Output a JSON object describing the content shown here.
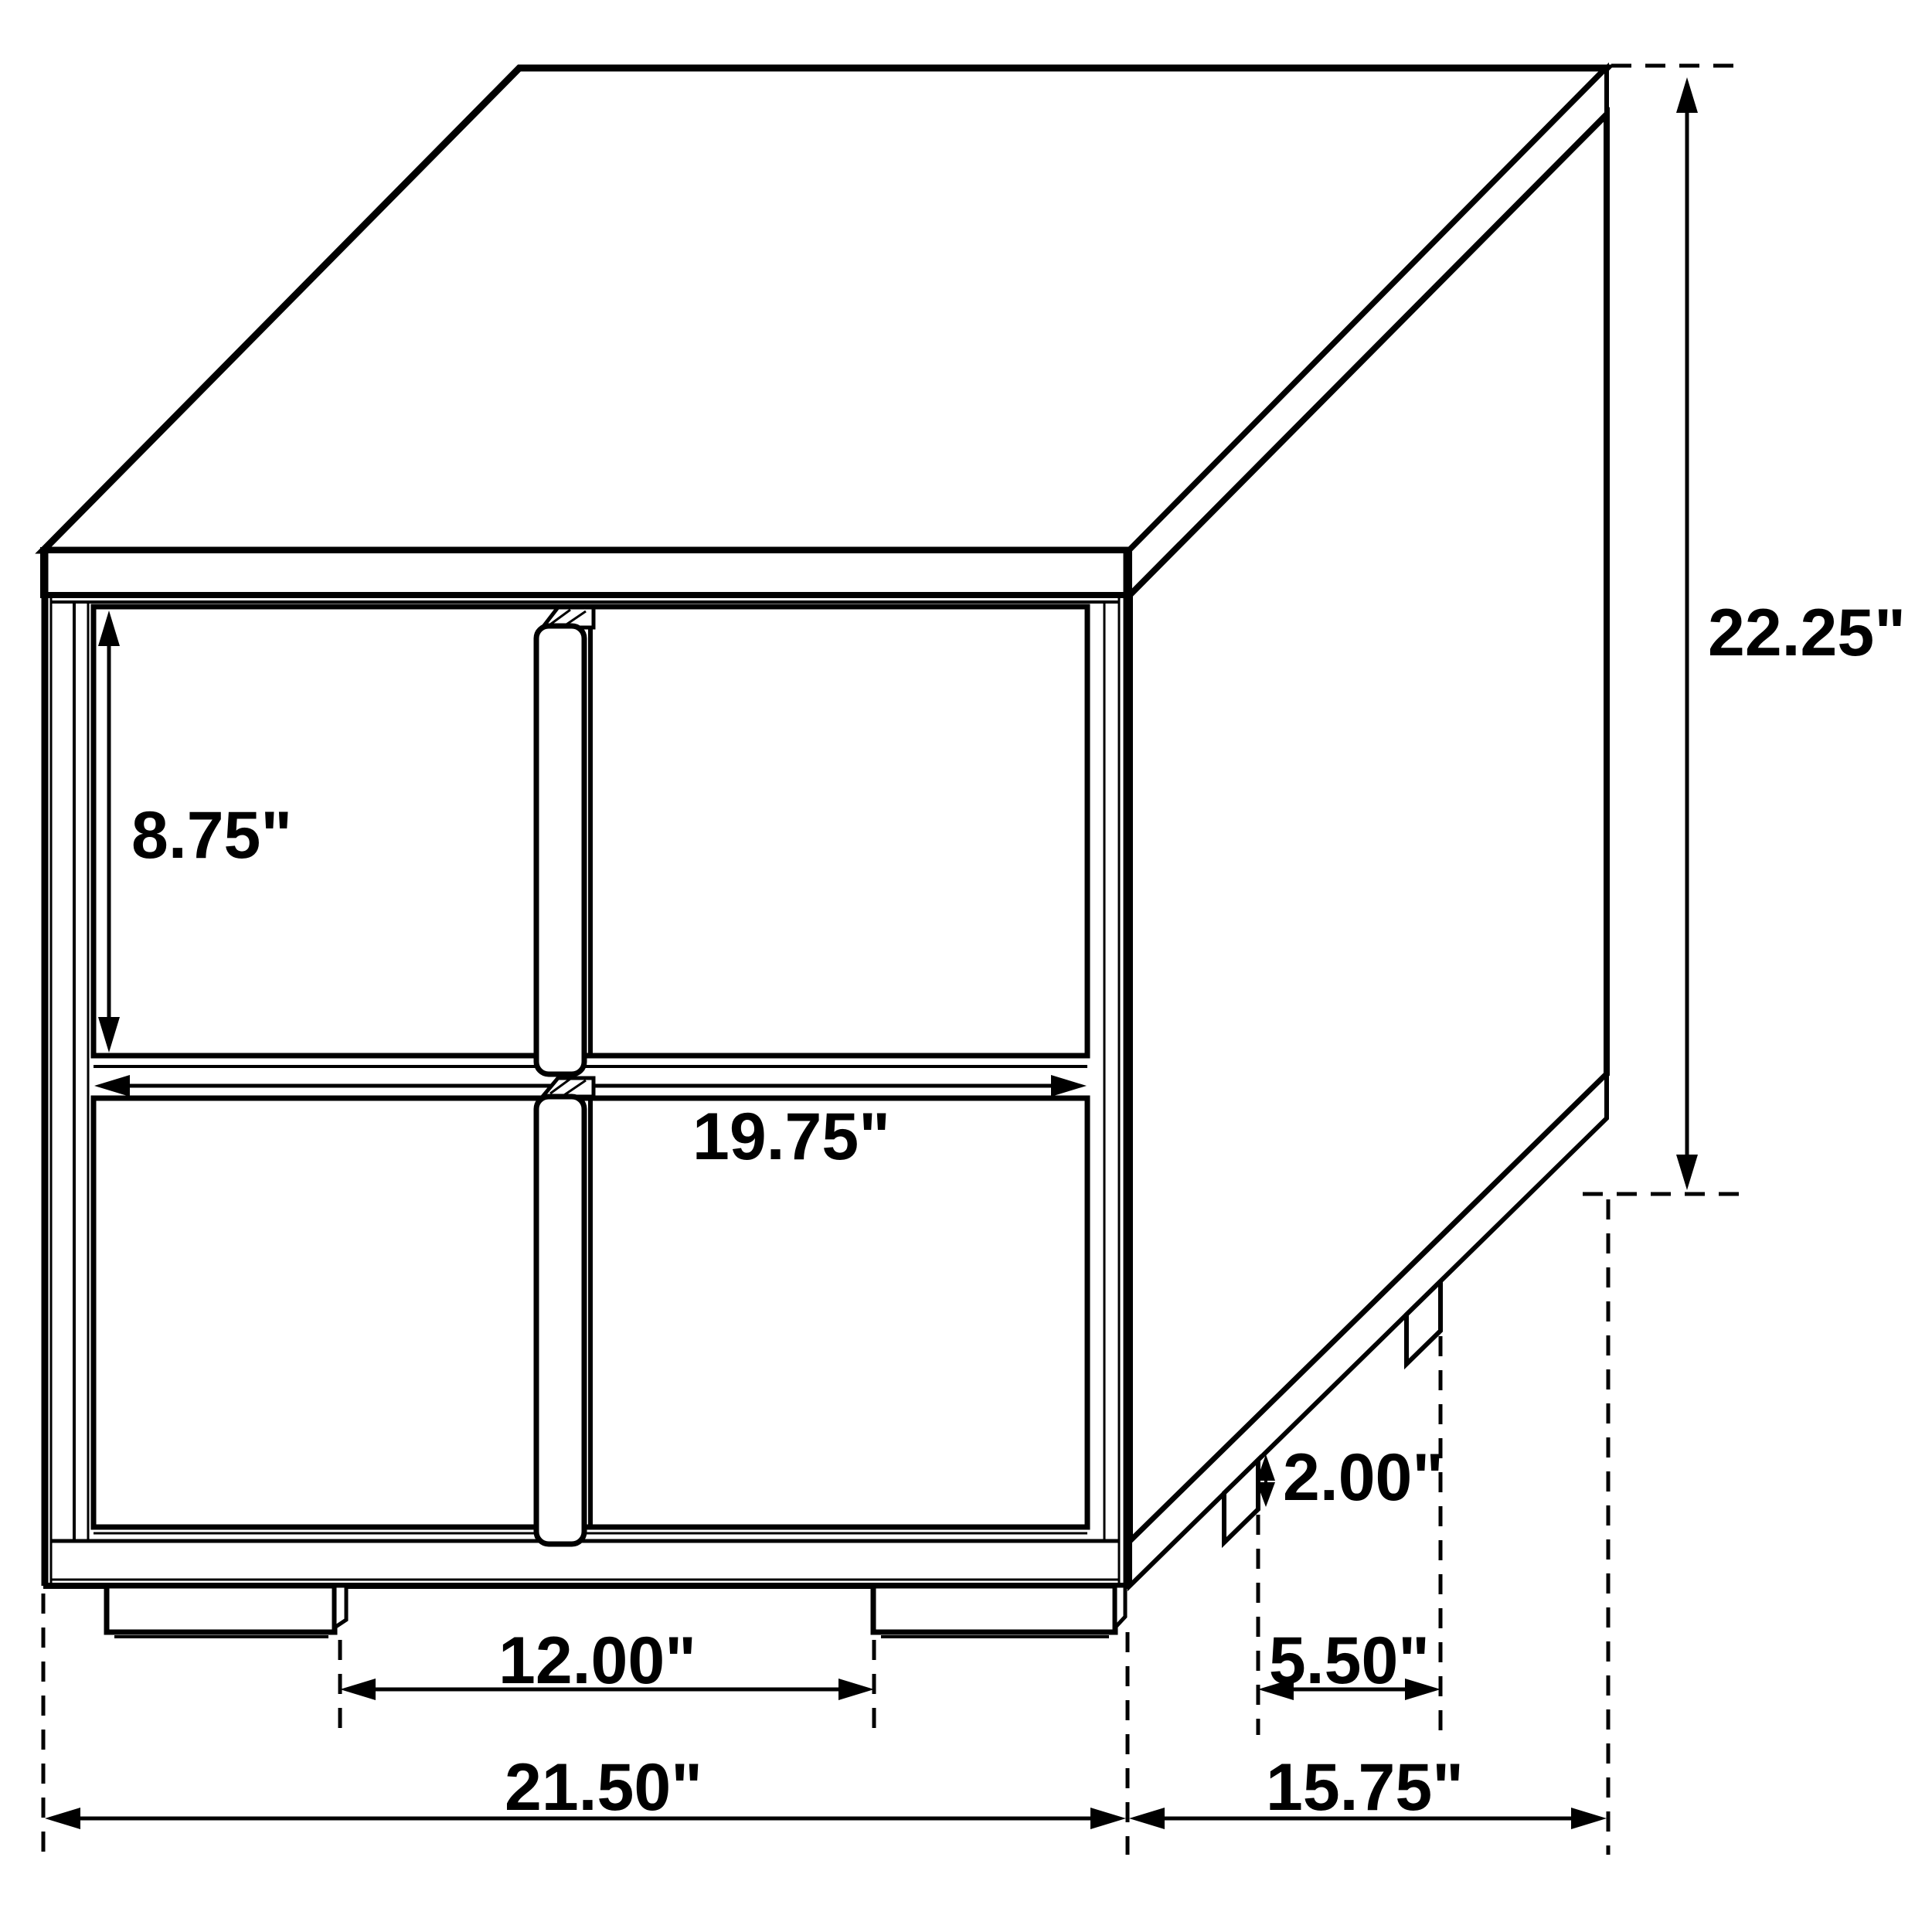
{
  "page": {
    "background": "#ffffff",
    "line_color": "#000000"
  },
  "diagram": {
    "type": "furniture-dimension-drawing",
    "subject": "two-drawer nightstand with center vertical pulls",
    "unit": "inches",
    "labels": {
      "drawer_height": "8.75\"",
      "drawer_width": "19.75\"",
      "overall_height": "22.25\"",
      "side_foot_height": "2.00\"",
      "front_feet_gap": "12.00\"",
      "side_feet_gap": "5.50\"",
      "overall_width": "21.50\"",
      "overall_depth": "15.75\""
    }
  }
}
